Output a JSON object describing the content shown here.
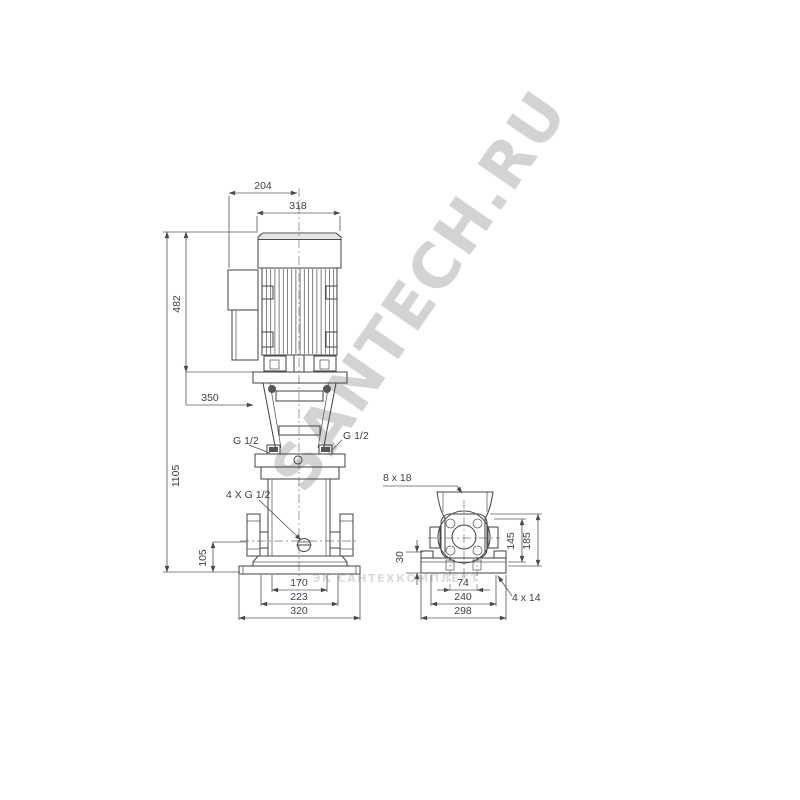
{
  "front_view": {
    "top_width": "204",
    "motor_width": "318",
    "motor_height": "482",
    "total_height": "1105",
    "clearance": "350",
    "port_center_height": "105",
    "port_left": "G 1/2",
    "port_right": "G 1/2",
    "plugs": "4 X G 1/2",
    "base_bolt_spacing": "170",
    "base_mid_width": "223",
    "base_width": "320"
  },
  "side_view": {
    "slot_label": "8 x 18",
    "foot_height": "30",
    "flange_center_height": "145",
    "flange_top_height": "185",
    "holes_spacing": "74",
    "base_bolt_width": "240",
    "base_width": "298",
    "holes_label": "4 x 14"
  },
  "watermarks": {
    "main": "SANTECH.RU",
    "bottom": "ЭК САНТЕХКОМПЛЕКТ"
  },
  "colors": {
    "line": "#4a4a4a",
    "dimension": "#5b5b5b",
    "text": "#3e3e48",
    "watermark": "#b9b9b9",
    "background": "#ffffff"
  }
}
